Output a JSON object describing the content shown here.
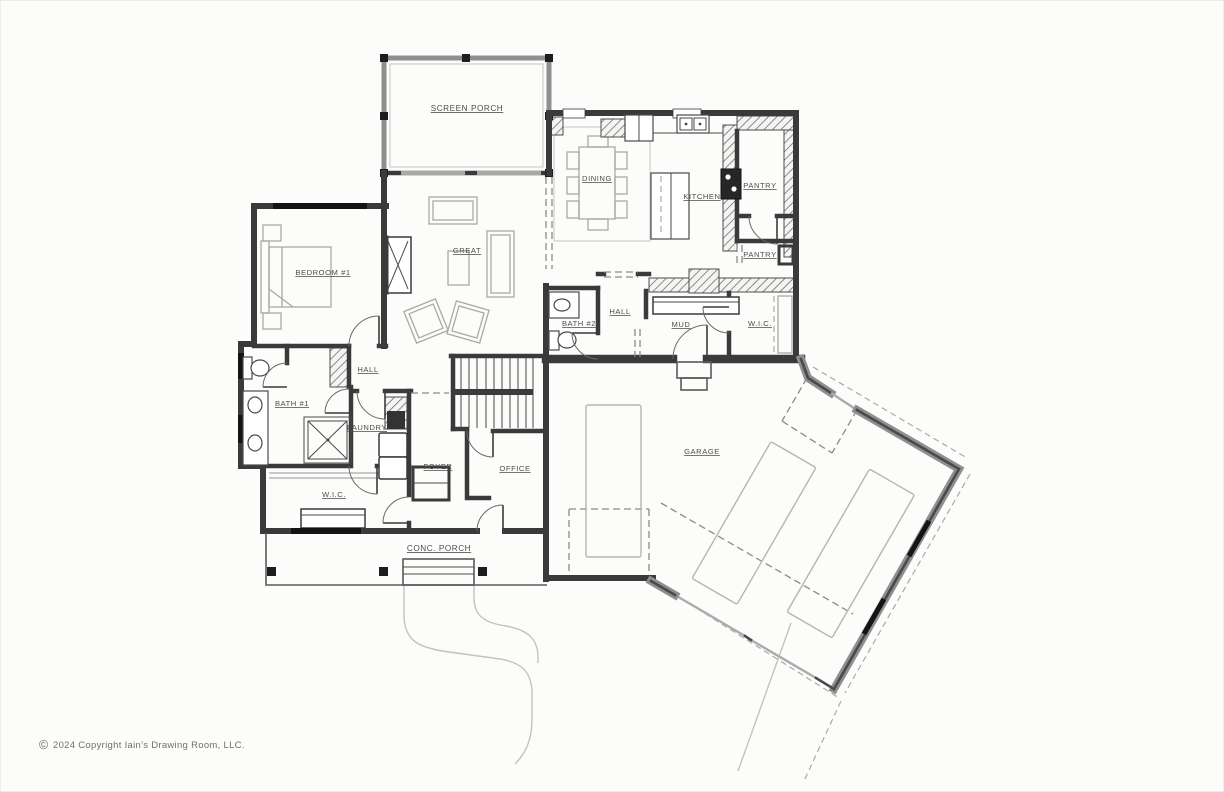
{
  "meta": {
    "copyright_symbol": "©",
    "copyright_text": "2024 Copyright Iain's Drawing Room, LLC."
  },
  "colors": {
    "paper": "#fcfcfa",
    "wall": "#3a3a3a",
    "wall_gray": "#8f8f8f",
    "window": "#141414",
    "opening": "#a9a9a7",
    "label": "#4d4d4d",
    "furniture": "#a8a8a6",
    "fixture": "#4a4a4a",
    "site": "#c2c2c0",
    "dash": "#8a8a8a",
    "copyright": "#6f6f6d"
  },
  "rooms": {
    "screen_porch": "SCREEN PORCH",
    "dining": "DINING",
    "kitchen": "KITCHEN",
    "pantry_upper": "PANTRY",
    "pantry_lower": "PANTRY",
    "great": "GREAT",
    "bedroom_1": "BEDROOM #1",
    "hall_west": "HALL",
    "bath_1": "BATH #1",
    "laundry": "LAUNDRY",
    "wic_west": "W.I.C.",
    "bath_2": "BATH #2",
    "hall_east": "HALL",
    "mud": "MUD",
    "wic_east": "W.I.C.",
    "foyer": "FOYER",
    "office": "OFFICE",
    "garage": "GARAGE",
    "conc_porch": "CONC. PORCH"
  }
}
